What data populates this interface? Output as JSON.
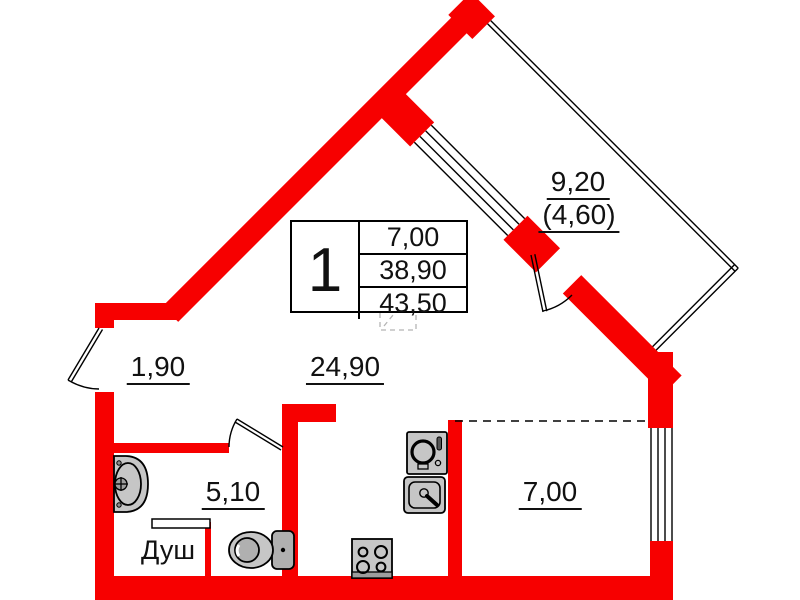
{
  "plan": {
    "unit_number": "1",
    "area_rows": [
      "7,00",
      "38,90",
      "43,50"
    ],
    "labels": {
      "hallway": "1,90",
      "living": "24,90",
      "bathroom": "5,10",
      "shower": "Душ",
      "room": "7,00",
      "balcony": "9,20",
      "balcony_reduced": "(4,60)"
    },
    "colors": {
      "wall": "#f70000",
      "fixture": "#c6c6c6",
      "line": "#000000"
    },
    "fixtures": [
      "sink-icon",
      "toilet-icon",
      "washing-machine-icon",
      "kitchen-sink-icon",
      "stove-icon"
    ]
  }
}
